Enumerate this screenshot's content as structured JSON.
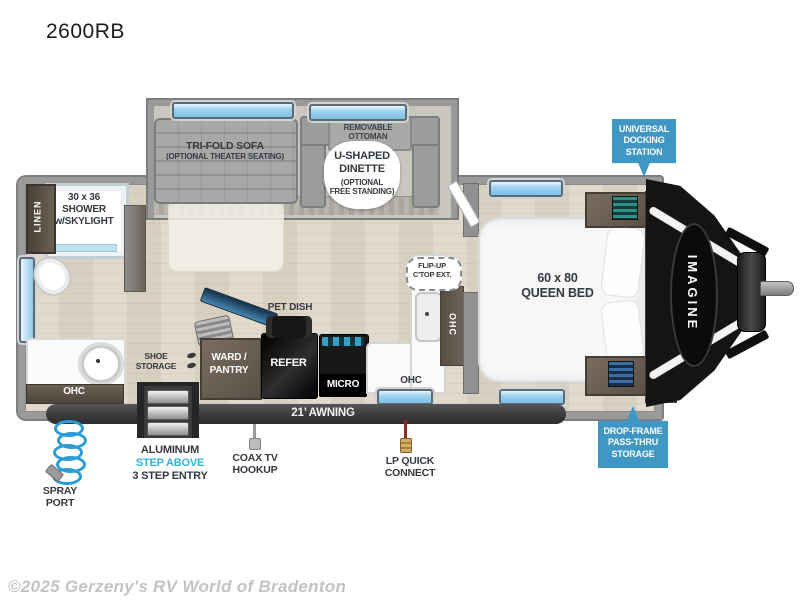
{
  "page": {
    "title": "2600RB",
    "watermark": "©2025 Gerzeny's RV World of Bradenton"
  },
  "colors": {
    "accent_blue": "#3e97c5",
    "highlight_cyan": "#2fb3e0",
    "label_dark": "#343a40",
    "awning_dark": "#3f3f41",
    "window_blue": "#9fd3f0",
    "wall_gray": "#9a9a9a",
    "floor_tan": "#ddd5c7",
    "cabinet_brown": "#6e6357",
    "appliance_black": "#141414"
  },
  "floorplan": {
    "logo": "IMAGINE",
    "living": {
      "sofa": [
        "TRI-FOLD SOFA",
        "(OPTIONAL THEATER SEATING)"
      ],
      "ottoman": [
        "REMOVABLE",
        "OTTOMAN"
      ],
      "dinette": [
        "U-SHAPED",
        "DINETTE",
        "(OPTIONAL",
        "FREE STANDING)"
      ]
    },
    "bathroom": {
      "shower": [
        "30 x 36",
        "SHOWER",
        "w/SKYLIGHT"
      ],
      "linen": "LINEN",
      "ohc": "OHC"
    },
    "kitchen": {
      "pet_dish": "PET DISH",
      "ward_pantry": [
        "WARD /",
        "PANTRY"
      ],
      "refer": "REFER",
      "micro": "MICRO",
      "ohc_side": "OHC",
      "ohc_bottom": "OHC",
      "flip_up": [
        "FLIP-UP",
        "C'TOP EXT."
      ]
    },
    "entry": {
      "shoe_storage": [
        "SHOE",
        "STORAGE"
      ]
    },
    "bedroom": {
      "queen_bed": [
        "60 x 80",
        "QUEEN BED"
      ],
      "overhead_cabinets": "OVERHEAD CABINETS"
    },
    "badges": {
      "docking": [
        "UNIVERSAL",
        "DOCKING",
        "STATION"
      ],
      "pass_thru": [
        "DROP-FRAME",
        "PASS-THRU",
        "STORAGE"
      ]
    },
    "exterior": {
      "awning": "21’ AWNING",
      "spray_port": [
        "SPRAY",
        "PORT"
      ],
      "steps": [
        "ALUMINUM",
        "STEP ABOVE",
        "3 STEP ENTRY"
      ],
      "coax": [
        "COAX TV",
        "HOOKUP"
      ],
      "lp_connect": [
        "LP QUICK",
        "CONNECT"
      ]
    }
  }
}
